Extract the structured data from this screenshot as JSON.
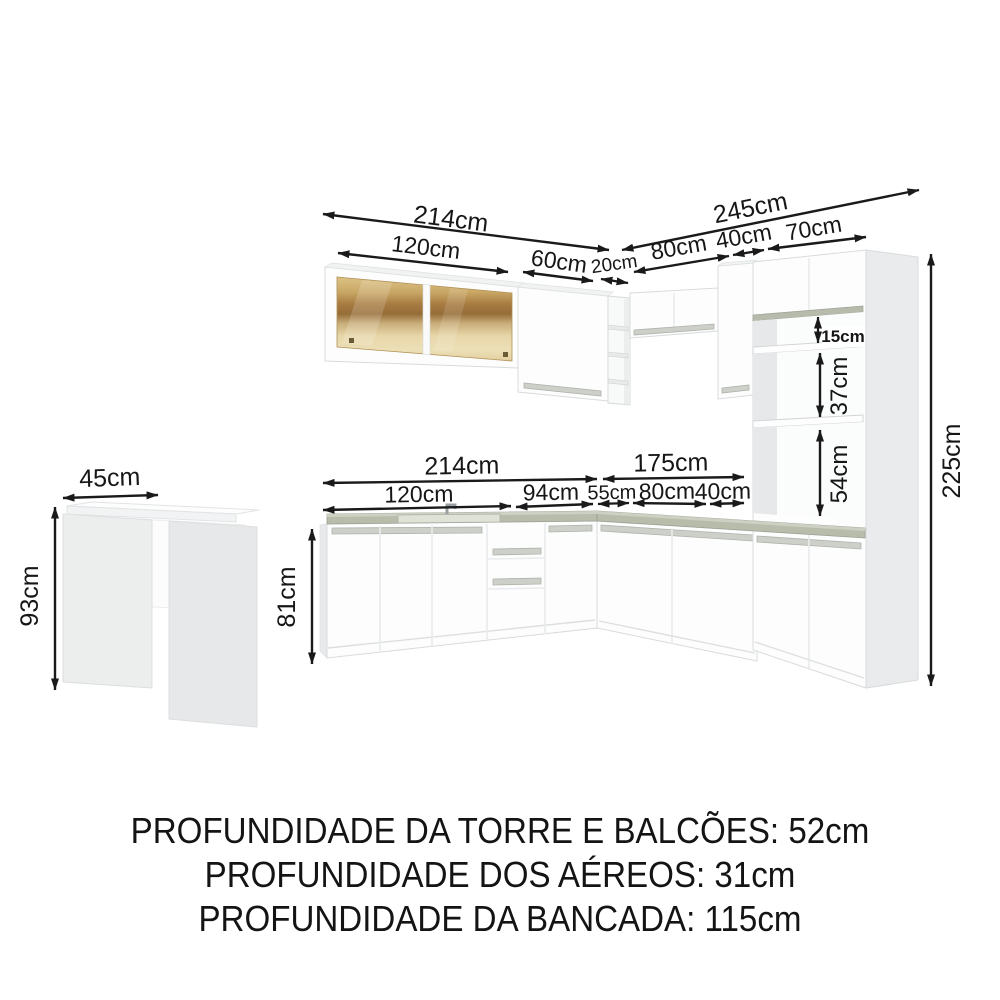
{
  "image": {
    "background": "#ffffff",
    "arrow_color": "#1a1a1a",
    "counter_color": "#b7bcab",
    "glass_color": "#c9a55e"
  },
  "dimensions": {
    "upper_left_total": "214cm",
    "upper_right_total": "245cm",
    "upper_glass_cabinet": "120cm",
    "upper_door_cabinet": "60cm",
    "upper_corner_shelf": "20cm",
    "upper_right_aereo": "80cm",
    "upper_right_cabinet": "40cm",
    "tower_width": "70cm",
    "counter_left_total": "214cm",
    "counter_right_total": "175cm",
    "counter_sub_1": "120cm",
    "counter_sub_2": "94cm",
    "counter_sub_3": "55cm",
    "counter_sub_4": "80cm",
    "counter_sub_5": "40cm",
    "tower_niche_top": "15cm",
    "tower_niche_mid": "37cm",
    "tower_niche_bottom": "54cm",
    "total_height": "225cm",
    "base_cabinet_height": "81cm",
    "table_depth": "45cm",
    "table_height": "93cm"
  },
  "footer": {
    "line1": "PROFUNDIDADE DA TORRE E BALCÕES: 52cm",
    "line2": "PROFUNDIDADE DOS AÉREOS: 31cm",
    "line3": "PROFUNDIDADE DA BANCADA: 115cm"
  }
}
